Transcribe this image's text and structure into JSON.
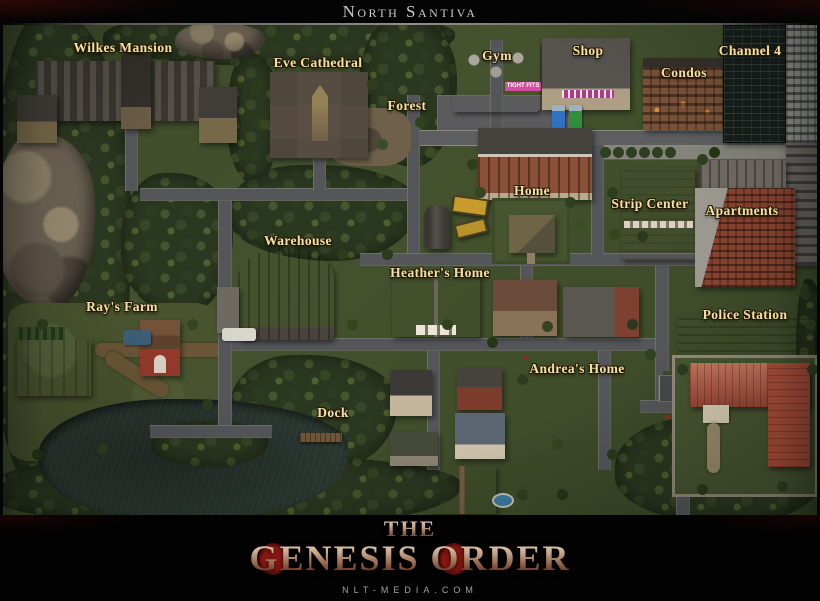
{
  "header": {
    "title": "North Santiva"
  },
  "map": {
    "region_name": "North Santiva",
    "locations": [
      {
        "name": "Wilkes Mansion",
        "x": 120,
        "y": 23
      },
      {
        "name": "Eve Cathedral",
        "x": 315,
        "y": 38
      },
      {
        "name": "Forest",
        "x": 404,
        "y": 81
      },
      {
        "name": "Gym",
        "x": 494,
        "y": 31
      },
      {
        "name": "Shop",
        "x": 585,
        "y": 26
      },
      {
        "name": "Channel 4",
        "x": 747,
        "y": 26
      },
      {
        "name": "Condos",
        "x": 681,
        "y": 48
      },
      {
        "name": "Home",
        "x": 529,
        "y": 166
      },
      {
        "name": "Strip Center",
        "x": 647,
        "y": 179
      },
      {
        "name": "Apartments",
        "x": 739,
        "y": 186
      },
      {
        "name": "Warehouse",
        "x": 295,
        "y": 216
      },
      {
        "name": "Heather's Home",
        "x": 437,
        "y": 248
      },
      {
        "name": "Ray's Farm",
        "x": 119,
        "y": 282
      },
      {
        "name": "Police Station",
        "x": 742,
        "y": 290
      },
      {
        "name": "Andrea's Home",
        "x": 574,
        "y": 344
      },
      {
        "name": "Dock",
        "x": 330,
        "y": 388
      }
    ],
    "signs": [
      {
        "location": "gym",
        "text": "TIGHT FITS"
      }
    ]
  },
  "footer": {
    "logo_top": "The",
    "logo_main": "Genesis Order",
    "website": "nlt-media.com"
  },
  "colors": {
    "label_gold": "#f2e2a2",
    "label_outline": "#241808",
    "grass": "#44522e",
    "forest": "#2b3820",
    "road": "#55565a",
    "water": "#2d3933",
    "logo_bronze": "#c9a98c",
    "logo_red": "#8e1712",
    "title_gray": "#cccccc"
  }
}
